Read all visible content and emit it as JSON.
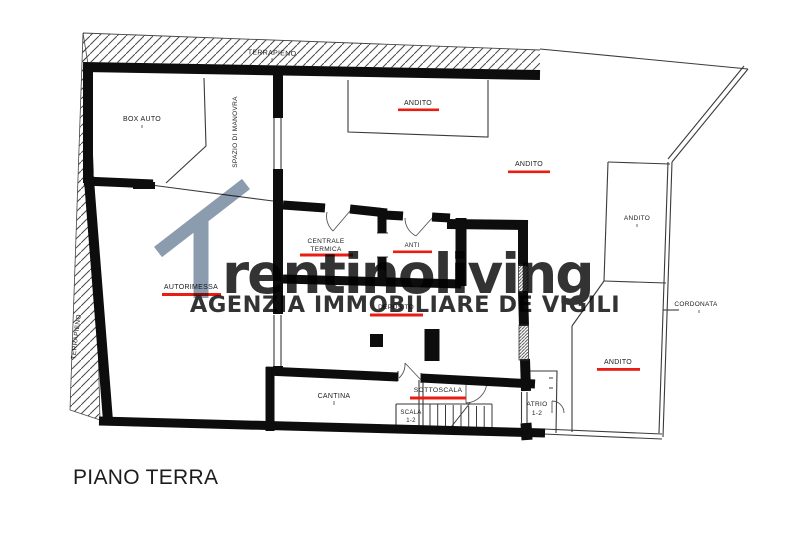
{
  "page": {
    "background": "#ffffff"
  },
  "plan": {
    "title": "PIANO TERRA",
    "highlight_color": "#e91d13",
    "zones": {
      "terrapieno_top": "TERRAPIENO",
      "terrapieno_left": "TERRAPIENO",
      "cordonata": "CORDONATA"
    },
    "rooms": {
      "box_auto": "BOX AUTO",
      "spazio_di_manovra": "SPAZIO DI MANOVRA",
      "andito_top": "ANDITO",
      "andito_center": "ANDITO",
      "andito_upper_right": "ANDITO",
      "andito_lower_right": "ANDITO",
      "autorimessa": "AUTORIMESSA",
      "centrale_termica": {
        "line1": "CENTRALE",
        "line2": "TERMICA"
      },
      "anti": "ANTI",
      "deposito": "DEPOSITO",
      "cantina": "CANTINA",
      "sottoscala": "SOTTOSCALA",
      "scala": {
        "line1": "SCALA",
        "line2": "1-2"
      },
      "atrio": {
        "line1": "ATRIO",
        "line2": "1-2"
      }
    }
  },
  "watermark": {
    "logo_leading": "1",
    "logo_text": "rentinoliving",
    "tagline": "AGENZIA IMMOBILIARE DE VIGILI",
    "color": "#7d91a5"
  }
}
